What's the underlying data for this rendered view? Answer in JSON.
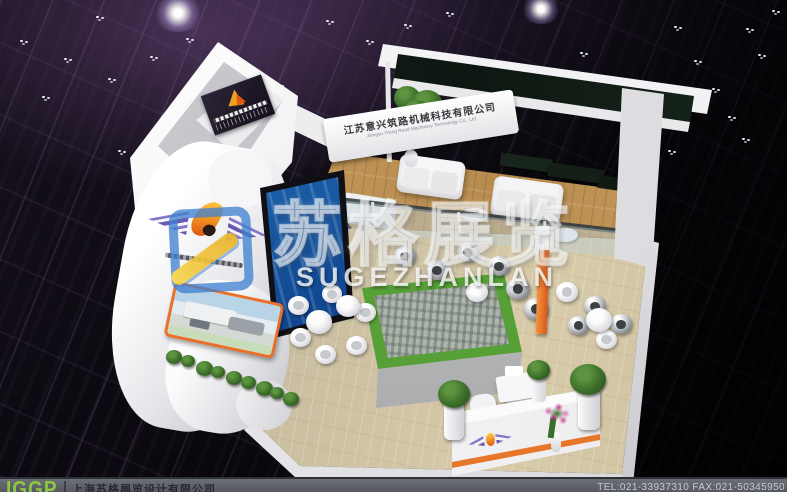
{
  "booth": {
    "header_sign": {
      "company_cn": "江苏意兴筑路机械科技有限公司",
      "company_en": "Jiangsu Yixing Road Machinery Technology Co., Ltd"
    }
  },
  "watermark": {
    "cn": "苏格展览",
    "en": "SUGEZHANLAN"
  },
  "footer": {
    "logo": "IGGP",
    "company": "上海苏格展览设计有限公司",
    "contact": "TEL:021-33937310  FAX:021-50345950"
  },
  "colors": {
    "accent_orange": "#e8762a",
    "footer_logo_green": "#8dc63f",
    "screen_blue": "#1b5fa8",
    "plant_green": "#3c6e2a",
    "wood_floor": "#c89e60",
    "watermark_blue": "#3e80d0",
    "watermark_yellow": "#eab225",
    "ceiling_purple": "#9e68b2"
  }
}
